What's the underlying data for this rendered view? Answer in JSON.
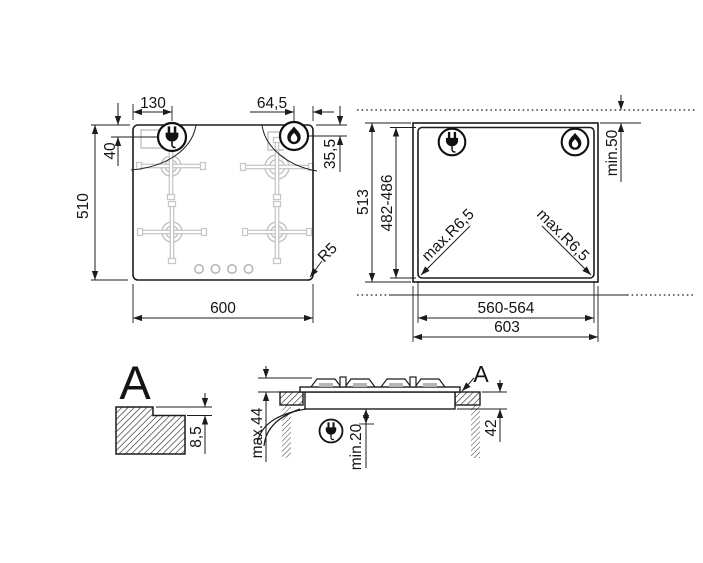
{
  "drawing": {
    "top_view": {
      "width": "600",
      "height": "510",
      "plug_offset_left": "130",
      "plug_offset_top": "40",
      "flame_offset_right": "64,5",
      "flame_offset_top": "35,5",
      "corner_radius": "R5"
    },
    "cutout_view": {
      "overall_width": "603",
      "overall_height": "513",
      "cutout_width": "560-564",
      "cutout_height": "482-486",
      "rear_clearance": "min.50",
      "corner_radius_left": "max.R6,5",
      "corner_radius_right": "max.R6,5"
    },
    "detail_view": {
      "label": "A",
      "step_depth": "8,5"
    },
    "section_view": {
      "label": "A",
      "overall_depth": "max.44",
      "bottom_clearance": "min.20",
      "recess_depth": "42"
    },
    "icons": {
      "plug": "power-plug-icon",
      "flame": "gas-flame-icon"
    },
    "colors": {
      "line": "#1c1c1c",
      "burner_gray": "#c6c6c6",
      "background": "#ffffff"
    }
  }
}
